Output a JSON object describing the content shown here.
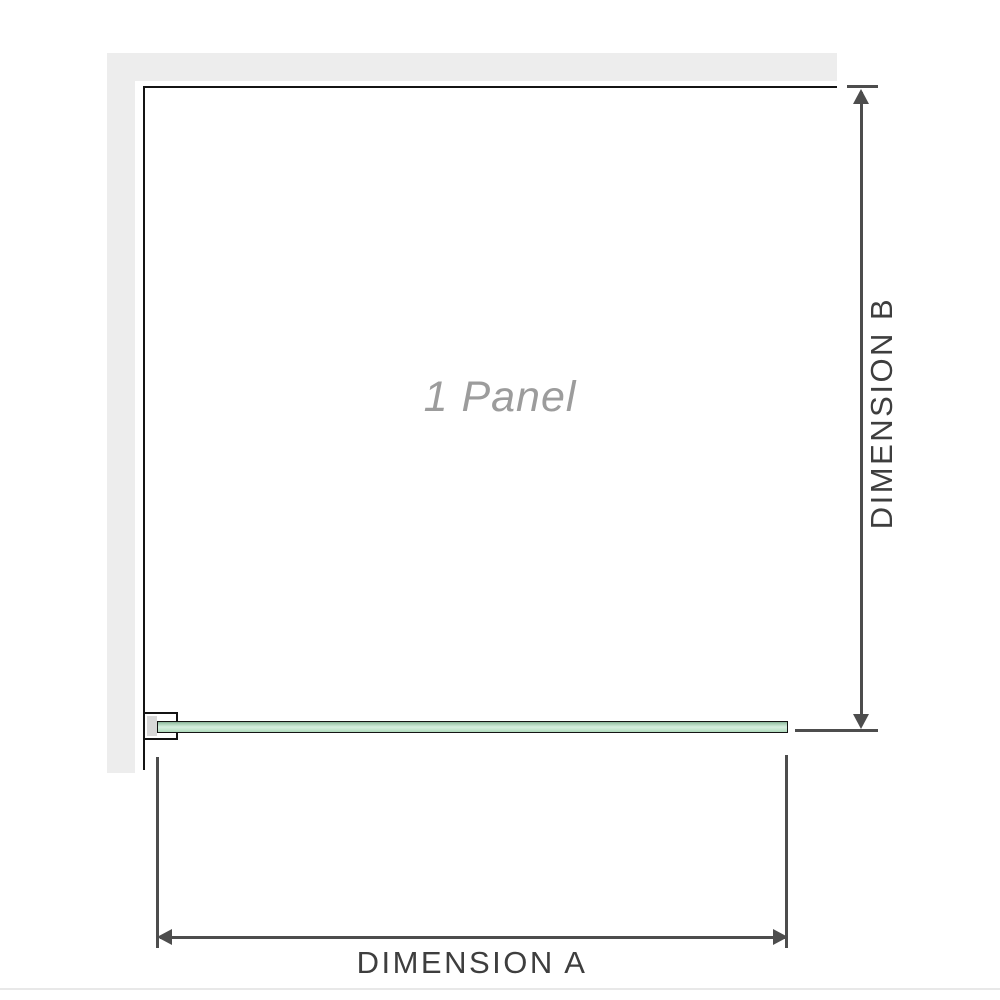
{
  "diagram": {
    "panel_label": "1 Panel",
    "dimension_a": {
      "label": "DIMENSION A",
      "orientation": "horizontal"
    },
    "dimension_b": {
      "label": "DIMENSION B",
      "orientation": "vertical"
    }
  },
  "icons": {
    "dimension_b_arrows": [
      "arrow-up-icon",
      "arrow-down-icon"
    ],
    "dimension_a_arrows": [
      "arrow-left-icon",
      "arrow-right-icon"
    ]
  },
  "colors": {
    "background": "#ffffff",
    "wall_gray": "#ededed",
    "wall_edge_outline": "#141414",
    "dimension_lines": "#4d4d4d",
    "dimension_label_text": "#3e3e3e",
    "panel_label_text": "#9c9c9c",
    "glass_green_light": "#d6eedf",
    "glass_green_dark": "#86af96",
    "bracket_pad_gray": "#d8d8d8",
    "bottom_divider": "#e8e8e8"
  }
}
